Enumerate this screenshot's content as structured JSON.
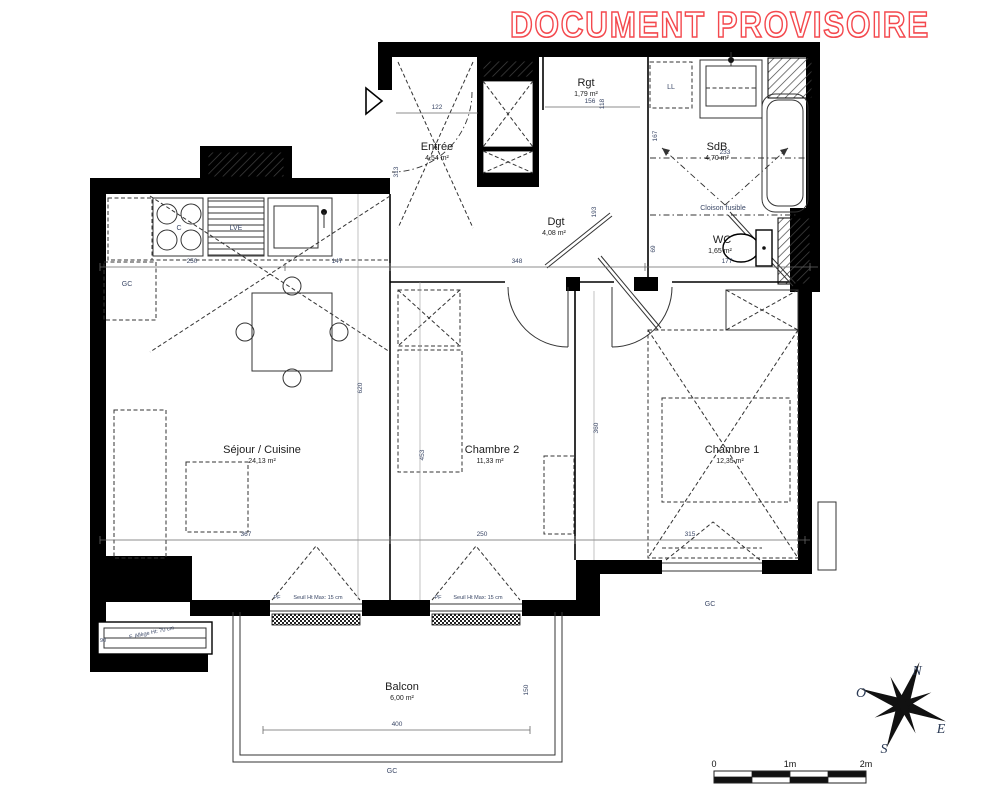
{
  "watermark": "DOCUMENT PROVISOIRE",
  "rooms": {
    "entree": {
      "name": "Entrée",
      "area": "4,54 m²"
    },
    "rgt": {
      "name": "Rgt",
      "area": "1,79 m²"
    },
    "sdb": {
      "name": "SdB",
      "area": "4,70 m²"
    },
    "dgt": {
      "name": "Dgt",
      "area": "4,08 m²"
    },
    "wc": {
      "name": "WC",
      "area": "1,65 m²"
    },
    "sejour": {
      "name": "Séjour / Cuisine",
      "area": "24,13 m²"
    },
    "chambre2": {
      "name": "Chambre 2",
      "area": "11,33 m²"
    },
    "chambre1": {
      "name": "Chambre 1",
      "area": "12,35 m²"
    },
    "balcon": {
      "name": "Balcon",
      "area": "6,00 m²"
    }
  },
  "labels": {
    "ll": "LL",
    "cloison_fusible": "Cloison fusible",
    "gc": "GC",
    "cuisson": "C",
    "lve": "LVE",
    "pf": "PF",
    "seuil": "Seuil Ht Max: 15 cm",
    "allege": "F. Allège Ht: 70 cm"
  },
  "dimensions": {
    "top_chain": [
      "250",
      "147",
      "348",
      "177"
    ],
    "bottom_chain": [
      "367",
      "250",
      "315"
    ],
    "entree_width": "122",
    "rgt_width": "156",
    "sdb_width": "233",
    "balcon_width": "400",
    "v_entree": "313",
    "v_rgt": "118",
    "v_dgt": "193",
    "v_sdb": "167",
    "v_wc": "69",
    "v_sejour": "620",
    "v_chambre2": "453",
    "v_chambre1": "360",
    "v_balcon": "150",
    "v_window": "90"
  },
  "compass": {
    "n": "N",
    "o": "O",
    "e": "E",
    "s": "S"
  },
  "scale_bar": {
    "zero": "0",
    "one": "1m",
    "two": "2m"
  },
  "colors": {
    "watermark": "#f4494e",
    "walls": "#000000",
    "dimension_text": "#3a4766"
  }
}
